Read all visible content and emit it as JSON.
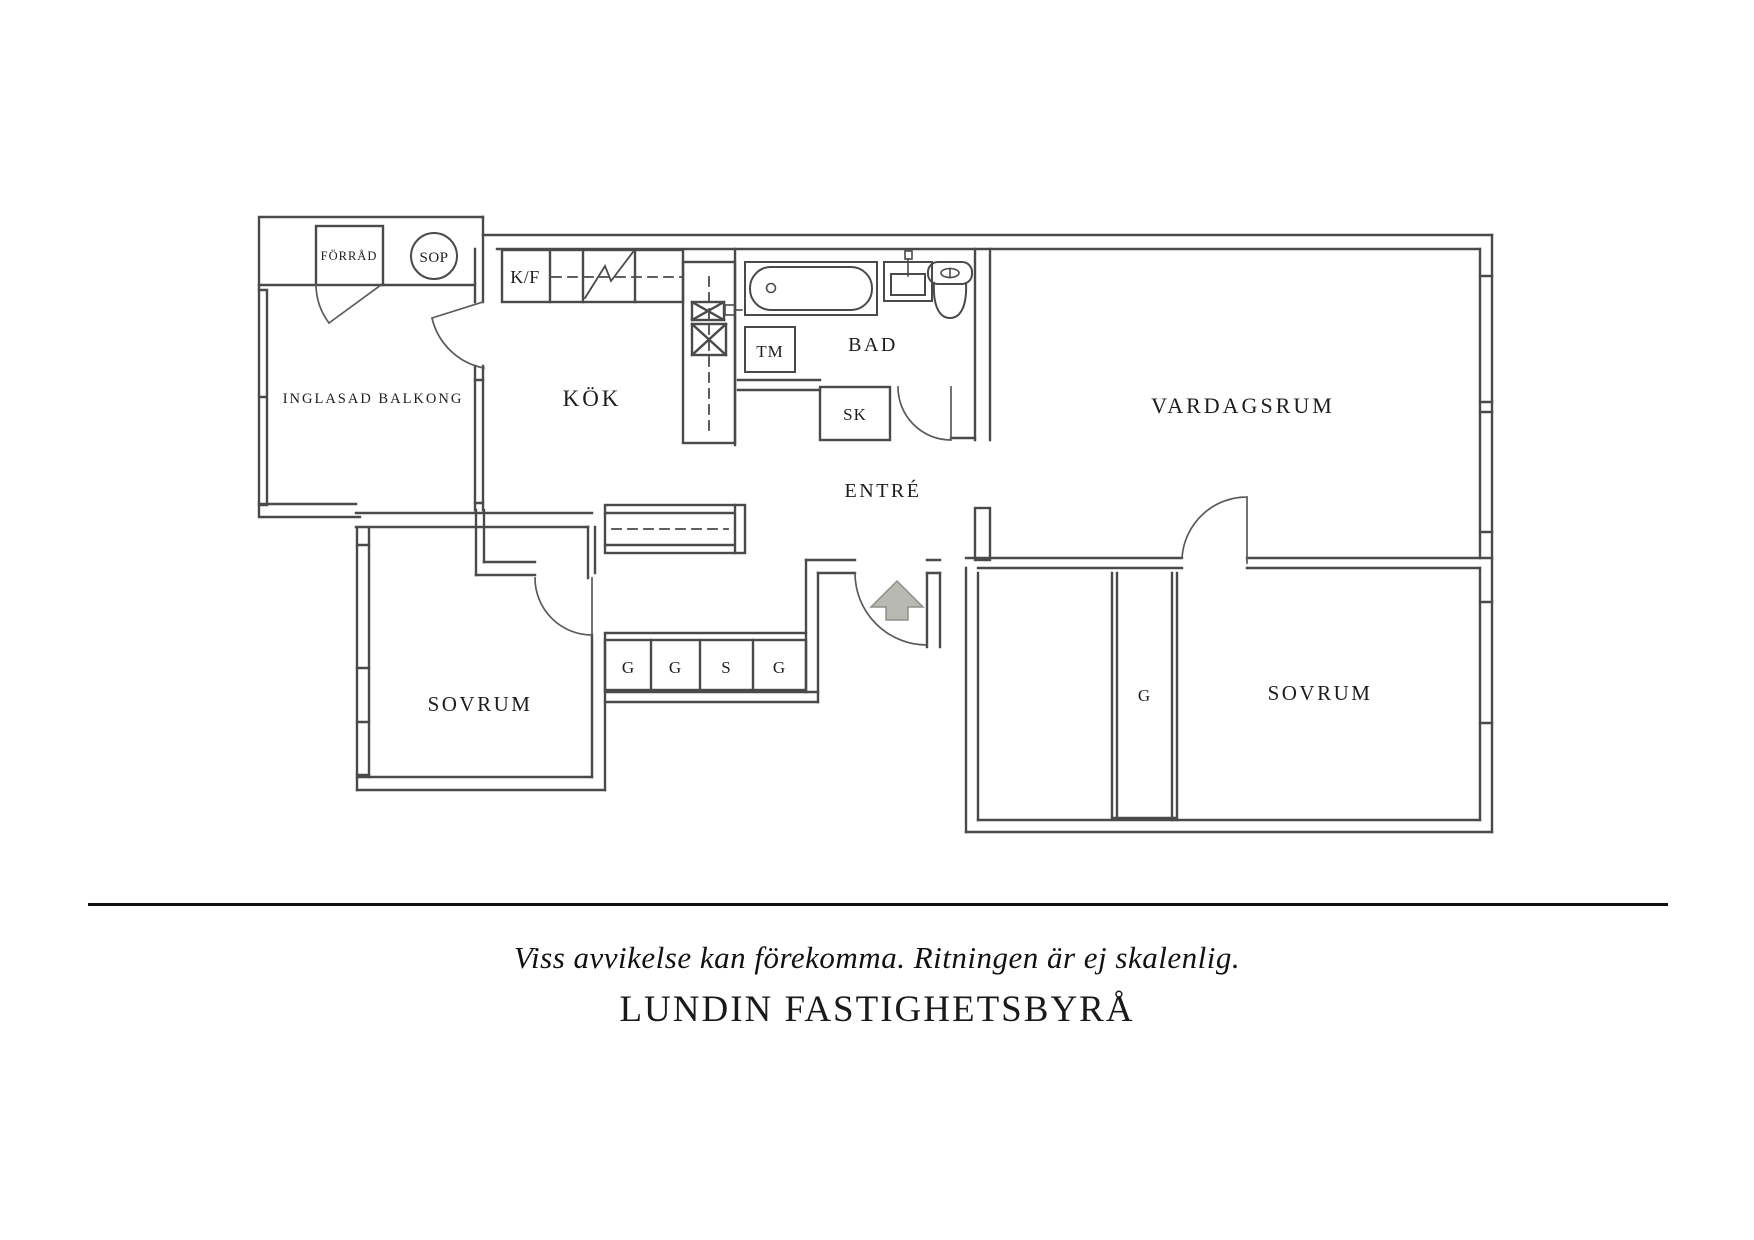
{
  "plan": {
    "rooms": {
      "balcony": {
        "label": "INGLASAD BALKONG"
      },
      "storage": {
        "label": "FÖRRÅD"
      },
      "garbage": {
        "label": "SOP"
      },
      "kitchen": {
        "label": "KÖK"
      },
      "bathroom": {
        "label": "BAD"
      },
      "entry": {
        "label": "ENTRÉ"
      },
      "living": {
        "label": "VARDAGSRUM"
      },
      "bedroom_left": {
        "label": "SOVRUM"
      },
      "bedroom_right": {
        "label": "SOVRUM"
      }
    },
    "fixtures": {
      "fridge_freezer": "K/F",
      "washing_machine": "TM",
      "cleaning_closet": "SK",
      "hall_wardrobes": [
        "G",
        "G",
        "S",
        "G"
      ],
      "bedroom_wardrobe": "G"
    },
    "colors": {
      "wall": "#4a4a4a",
      "text": "#1d1d1d",
      "arrow_fill": "#b9b9b4",
      "arrow_edge": "#8f8f8a",
      "background": "#ffffff"
    }
  },
  "footer": {
    "disclaimer": "Viss avvikelse kan förekomma. Ritningen är ej skalenlig.",
    "brand": "LUNDIN FASTIGHETSBYRÅ"
  }
}
